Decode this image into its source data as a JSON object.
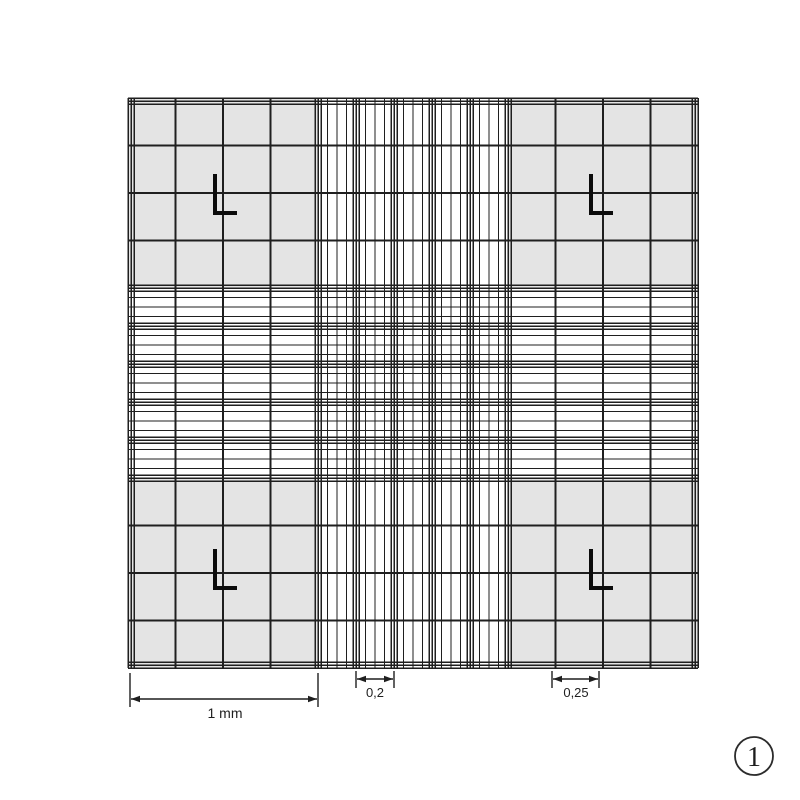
{
  "figure": {
    "background": "#ffffff",
    "line_color": "#1f1f1f",
    "mark_color": "#0b0b0b",
    "fill_color": "#e4e4e4",
    "grid": {
      "left": 128,
      "top": 98,
      "size": 570,
      "mm": 3,
      "px_per_mm": 190,
      "corner_divisions_per_mm": 4,
      "corner_cell_mm": 0.25,
      "center_group_mm": 0.2,
      "center_groups": 5,
      "center_subdivisions_per_group": 4,
      "triple_line_offset": 3
    },
    "l_marks": [
      {
        "name": "top-left",
        "x": 215,
        "y_top": 174,
        "y_corner": 213,
        "x_right": 237
      },
      {
        "name": "top-right",
        "x": 591,
        "y_top": 174,
        "y_corner": 213,
        "x_right": 613
      },
      {
        "name": "bottom-left",
        "x": 215,
        "y_top": 549,
        "y_corner": 588,
        "x_right": 237
      },
      {
        "name": "bottom-right",
        "x": 591,
        "y_top": 549,
        "y_corner": 588,
        "x_right": 613
      }
    ],
    "dimensions": [
      {
        "id": "dimension-1mm",
        "label": "1 mm",
        "x1": 130,
        "x2": 318,
        "arrow_y": 699,
        "tick_top": 673,
        "tick_bottom": 707,
        "label_x": 225,
        "label_y": 718,
        "font_size": 14
      },
      {
        "id": "dimension-0-2",
        "label": "0,2",
        "x1": 356,
        "x2": 394,
        "arrow_y": 679,
        "tick_top": 671,
        "tick_bottom": 688,
        "label_x": 375,
        "label_y": 697,
        "font_size": 13
      },
      {
        "id": "dimension-0-25",
        "label": "0,25",
        "x1": 552,
        "x2": 599,
        "arrow_y": 679,
        "tick_top": 671,
        "tick_bottom": 688,
        "label_x": 576,
        "label_y": 697,
        "font_size": 13
      }
    ],
    "figure_number": {
      "label": "1",
      "cx": 754,
      "cy": 756,
      "r": 19,
      "circle_color": "#2b2b2b",
      "text_color": "#1d1d1d"
    }
  }
}
